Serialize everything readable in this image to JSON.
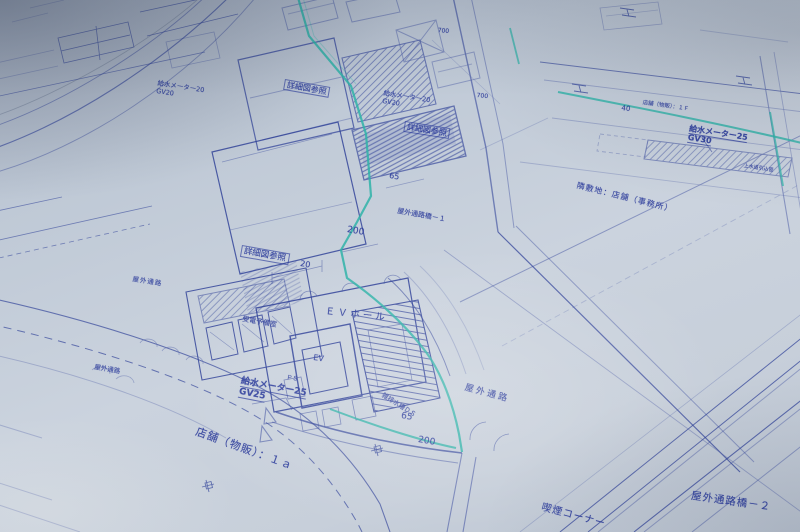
{
  "drawing": {
    "kind": "site-plan-blueprint-photo"
  },
  "labels": {
    "detail_ref": "詳細図参照",
    "water_meter_25": "給水メーター25",
    "water_meter_20": "給水メーター20",
    "gv30": "GV30",
    "gv25": "GV25",
    "gv20": "GV20",
    "ev_hall": "ＥＶホール",
    "ev": "EV",
    "substation_room": "受電予備室",
    "outdoor_passage": "屋外通路",
    "bridge_1": "屋外通路橋－１",
    "bridge_2": "屋外通路橋－２",
    "smoking_corner": "喫煙コーナー",
    "shop_retail_1a": "店舗（物販）：１ａ",
    "shop_retail_1f": "店舗（物販）：１Ｆ",
    "adjacent_site": "隣敷地：店舗（事務所）",
    "waste_water_ds": "雑排水槽ＤＳ",
    "ps": "ＰＳ",
    "water_intake": "上水道引込管"
  },
  "dims": {
    "d20": "20",
    "d40": "40",
    "d65": "65",
    "d200": "200",
    "d700": "700"
  },
  "colors": {
    "ink": "#2c3e97",
    "teal": "#2fb3a8",
    "paper": "#c5ceda",
    "pencil": "#76839a"
  }
}
